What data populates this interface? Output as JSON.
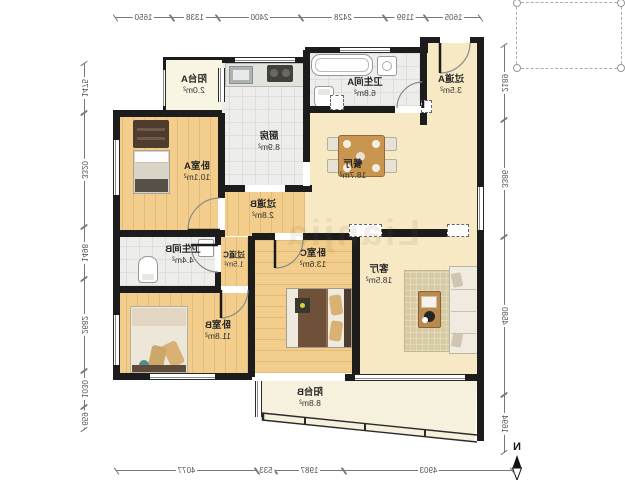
{
  "rooms": [
    {
      "id": "balcony-a",
      "name": "阳台A",
      "area": "2.0m²"
    },
    {
      "id": "kitchen",
      "name": "厨房",
      "area": "8.9m²"
    },
    {
      "id": "bathroom-a",
      "name": "卫生间A",
      "area": "6.8m²"
    },
    {
      "id": "hallway-a",
      "name": "过道A",
      "area": "3.5m²"
    },
    {
      "id": "dining-room",
      "name": "餐厅",
      "area": "18.7m²"
    },
    {
      "id": "bedroom-a",
      "name": "卧室A",
      "area": "10.1m²"
    },
    {
      "id": "hallway-b",
      "name": "过道B",
      "area": "2.8m²"
    },
    {
      "id": "bathroom-b",
      "name": "卫生间B",
      "area": "4.4m²"
    },
    {
      "id": "hallway-c",
      "name": "过道C",
      "area": "1.5m²"
    },
    {
      "id": "bedroom-b",
      "name": "卧室B",
      "area": "11.8m²"
    },
    {
      "id": "bedroom-c",
      "name": "卧室C",
      "area": "13.6m²"
    },
    {
      "id": "living-room",
      "name": "客厅",
      "area": "18.5m²"
    },
    {
      "id": "balcony-b",
      "name": "阳台B",
      "area": "8.8m²"
    }
  ],
  "dimensions": {
    "top": [
      "1605",
      "1199",
      "2428",
      "2400",
      "1338",
      "1650"
    ],
    "left": [
      "2189",
      "3386",
      "4580",
      "1694"
    ],
    "right": [
      "1475",
      "3320",
      "1498",
      "2682",
      "1030",
      "659"
    ],
    "bottom": [
      "4903",
      "1987",
      "533",
      "4077"
    ]
  },
  "compass": {
    "label": "N"
  },
  "watermark": {
    "text": "Lianjia"
  },
  "colors": {
    "wall": "#1C1C1C",
    "wood_floor": "#F2CD8C",
    "cream_floor": "#F7E9C4",
    "tile_floor": "#EDEDEB",
    "balcony_floor": "#F5F1DC"
  }
}
